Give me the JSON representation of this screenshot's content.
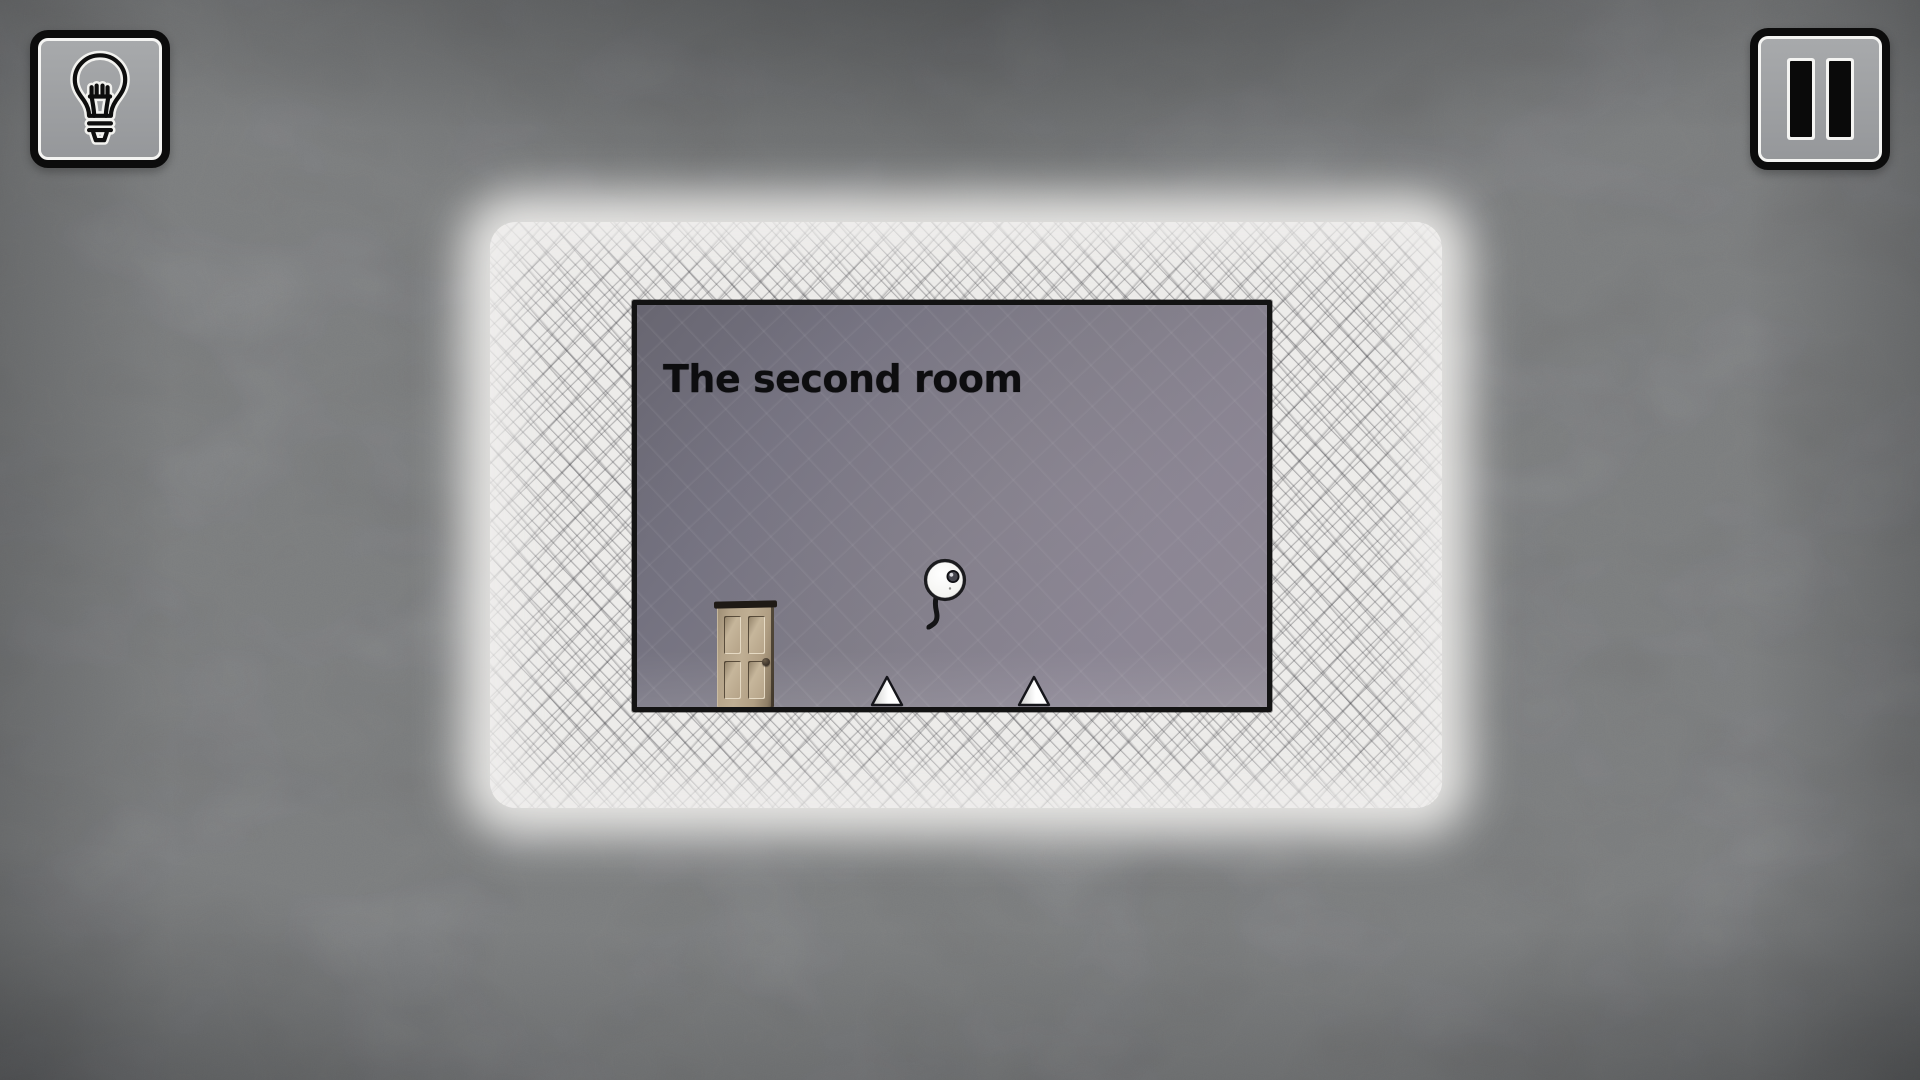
{
  "hud": {
    "hint_button": {
      "icon": "lightbulb-icon",
      "purpose": "hint"
    },
    "pause_button": {
      "icon": "pause-icon",
      "purpose": "pause"
    }
  },
  "scene": {
    "title": "The second room",
    "entities": {
      "door": "door",
      "player": "player-ball",
      "spikes": [
        "spike",
        "spike"
      ]
    }
  },
  "colors": {
    "background_concrete": "#8c8e90",
    "paper": "#edecea",
    "hatch_ink": "#2d2d34",
    "room_dark": "#686671",
    "room_mid": "#7f7c87",
    "room_light": "#8e8994",
    "outline_ink": "#131313",
    "door_wood": "#b5a489",
    "door_frame": "#1f1a15",
    "spike_fill": "#ffffff",
    "button_face": "#9ea0a2",
    "button_border": "#0c0c0c",
    "button_ring": "#f4f4f2",
    "title_text": "#0d0d0f"
  }
}
